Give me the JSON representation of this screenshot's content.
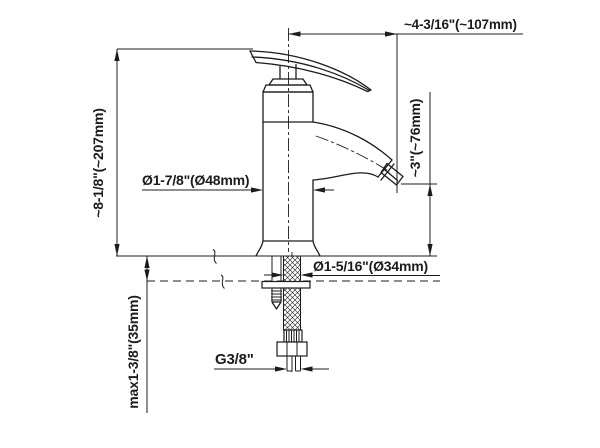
{
  "drawing": {
    "background": "#ffffff",
    "line_color": "#1c1c1c",
    "labels": {
      "spout_reach": "~4-3/16\"(~107mm)",
      "overall_height": "~8-1/8\"(~207mm)",
      "spout_outlet_height": "~3\"(~76mm)",
      "body_diameter": "Ø1-7/8\"(Ø48mm)",
      "mounting_hole_diameter": "Ø1-5/16\"(Ø34mm)",
      "max_deck_thickness": "max1-3/8\"(35mm)",
      "supply_thread": "G3/8\""
    }
  }
}
